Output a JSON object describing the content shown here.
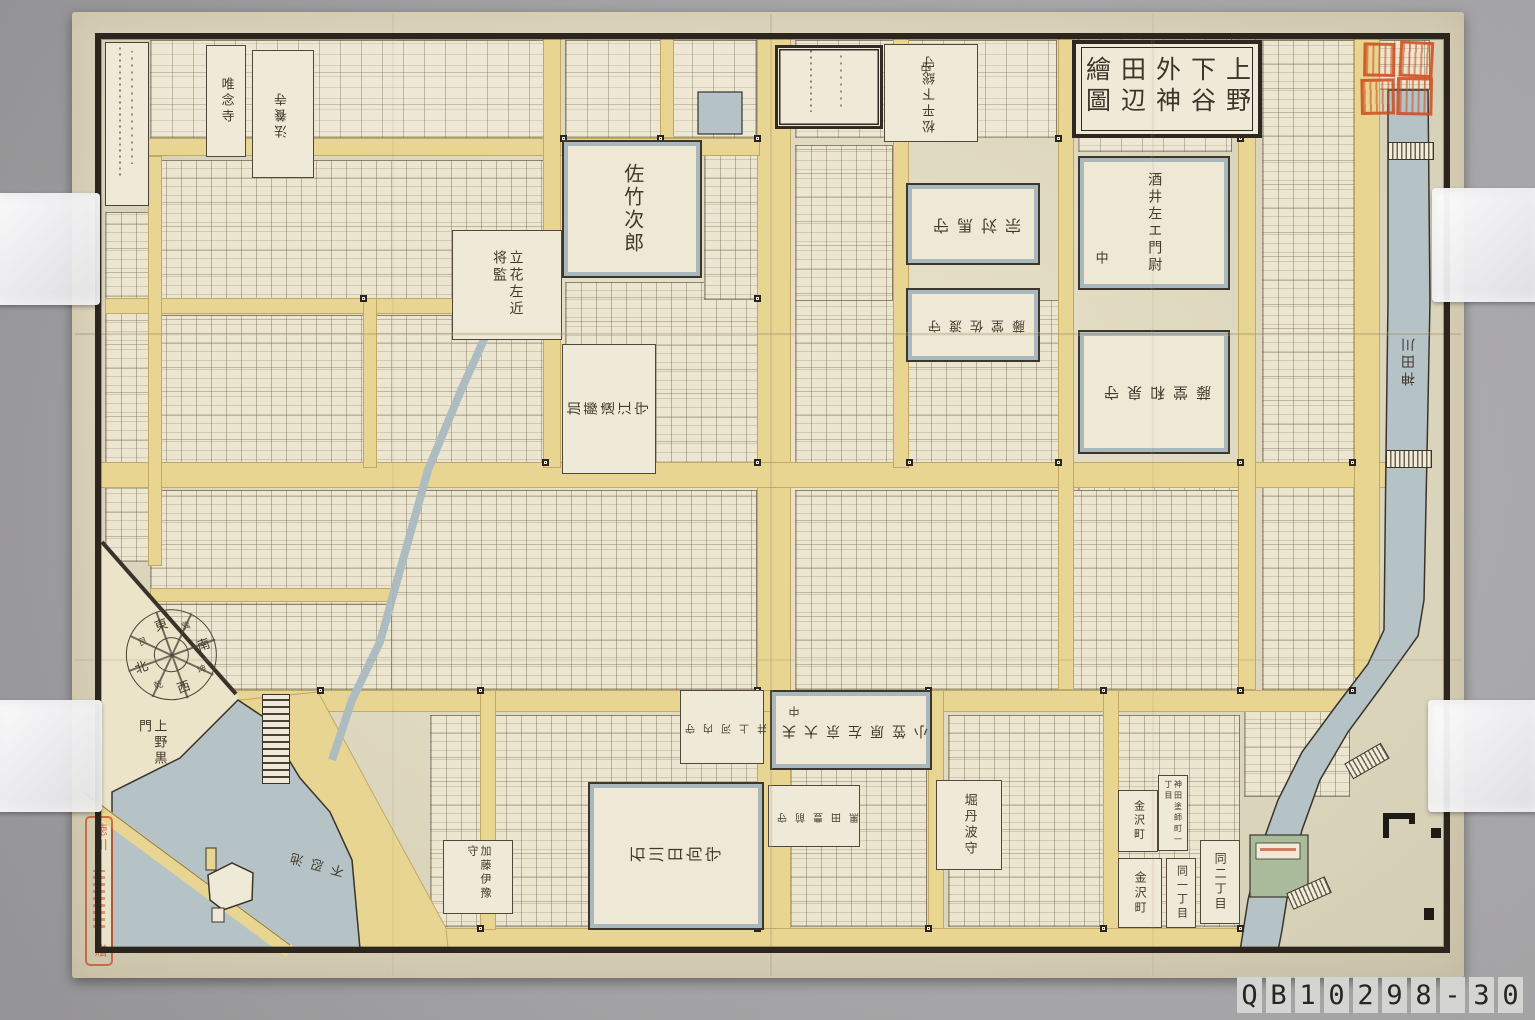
{
  "map": {
    "title": "上野下谷外神田辺繪圖",
    "blocks": [
      {
        "t": "佐竹次郎",
        "x": 562,
        "y": 140,
        "w": 140,
        "h": 138,
        "fs": 20,
        "rot": 0,
        "mode": "v",
        "kind": "big"
      },
      {
        "t": "宗対馬守",
        "x": 906,
        "y": 183,
        "w": 134,
        "h": 82,
        "fs": 16,
        "rot": 180,
        "mode": "h",
        "kind": "big"
      },
      {
        "t": "藤堂佐渡守",
        "x": 906,
        "y": 288,
        "w": 134,
        "h": 74,
        "fs": 13,
        "rot": 180,
        "mode": "h",
        "kind": "big"
      },
      {
        "t": "酒井左エ門尉",
        "x": 1078,
        "y": 156,
        "w": 152,
        "h": 134,
        "fs": 14,
        "rot": 0,
        "mode": "v",
        "kind": "big"
      },
      {
        "t": "中",
        "x": 1090,
        "y": 246,
        "w": 20,
        "h": 26,
        "fs": 13,
        "rot": 0,
        "mode": "v",
        "kind": "bare"
      },
      {
        "t": "藤堂和泉守",
        "x": 1078,
        "y": 330,
        "w": 152,
        "h": 124,
        "fs": 15,
        "rot": 180,
        "mode": "h",
        "kind": "big"
      },
      {
        "t": "立花左近将監",
        "x": 452,
        "y": 230,
        "w": 110,
        "h": 110,
        "fs": 14,
        "rot": 0,
        "mode": "v",
        "kind": "box",
        "mh": 70
      },
      {
        "t": "加藤遠江守",
        "x": 562,
        "y": 344,
        "w": 94,
        "h": 130,
        "fs": 14,
        "rot": -90,
        "mode": "v",
        "kind": "box"
      },
      {
        "t": "松平下総守",
        "x": 884,
        "y": 44,
        "w": 94,
        "h": 98,
        "fs": 13,
        "rot": 180,
        "mode": "v",
        "kind": "box"
      },
      {
        "t": "中",
        "x": 918,
        "y": 56,
        "w": 18,
        "h": 22,
        "fs": 11,
        "rot": 180,
        "mode": "v",
        "kind": "bare"
      },
      {
        "t": "唯念寺",
        "x": 206,
        "y": 45,
        "w": 40,
        "h": 112,
        "fs": 13,
        "rot": 0,
        "mode": "v",
        "kind": "box"
      },
      {
        "t": "法養寺",
        "x": 252,
        "y": 50,
        "w": 62,
        "h": 128,
        "fs": 13,
        "rot": 180,
        "mode": "v",
        "kind": "box"
      },
      {
        "t": "小笠原左京大夫",
        "x": 770,
        "y": 690,
        "w": 162,
        "h": 80,
        "fs": 14,
        "rot": 180,
        "mode": "h",
        "kind": "big"
      },
      {
        "t": "中",
        "x": 786,
        "y": 700,
        "w": 18,
        "h": 22,
        "fs": 11,
        "rot": 180,
        "mode": "v",
        "kind": "bare"
      },
      {
        "t": "井上河内守",
        "x": 680,
        "y": 690,
        "w": 84,
        "h": 74,
        "fs": 10,
        "rot": 180,
        "mode": "h",
        "kind": "box"
      },
      {
        "t": "石川日向守",
        "x": 588,
        "y": 782,
        "w": 176,
        "h": 148,
        "fs": 16,
        "rot": -90,
        "mode": "v",
        "kind": "big"
      },
      {
        "t": "黒田豊前守",
        "x": 768,
        "y": 785,
        "w": 92,
        "h": 62,
        "fs": 10,
        "rot": 180,
        "mode": "h",
        "kind": "box"
      },
      {
        "t": "堀丹波守",
        "x": 936,
        "y": 780,
        "w": 66,
        "h": 90,
        "fs": 13,
        "rot": 0,
        "mode": "v",
        "kind": "box"
      },
      {
        "t": "加藤伊豫守",
        "x": 443,
        "y": 840,
        "w": 70,
        "h": 74,
        "fs": 11,
        "rot": 0,
        "mode": "v",
        "kind": "box"
      },
      {
        "t": "金沢町",
        "x": 1118,
        "y": 790,
        "w": 40,
        "h": 62,
        "fs": 11,
        "rot": 0,
        "mode": "v",
        "kind": "box"
      },
      {
        "t": "金沢町",
        "x": 1118,
        "y": 858,
        "w": 44,
        "h": 70,
        "fs": 12,
        "rot": 0,
        "mode": "v",
        "kind": "box"
      },
      {
        "t": "同一丁目",
        "x": 1166,
        "y": 858,
        "w": 30,
        "h": 70,
        "fs": 11,
        "rot": 0,
        "mode": "v",
        "kind": "box"
      },
      {
        "t": "同二丁目",
        "x": 1200,
        "y": 840,
        "w": 40,
        "h": 84,
        "fs": 12,
        "rot": 0,
        "mode": "v",
        "kind": "box"
      },
      {
        "t": "神田塗師町一丁目",
        "x": 1158,
        "y": 775,
        "w": 30,
        "h": 76,
        "fs": 8,
        "rot": 0,
        "mode": "v",
        "kind": "box"
      },
      {
        "t": "神田川",
        "x": 1396,
        "y": 285,
        "w": 26,
        "h": 150,
        "fs": 14,
        "rot": 180,
        "mode": "v",
        "kind": "bare"
      },
      {
        "t": "上野黒門",
        "x": 128,
        "y": 716,
        "w": 46,
        "h": 66,
        "fs": 13,
        "rot": 0,
        "mode": "v",
        "kind": "bare",
        "mh": 60
      },
      {
        "t": "不忍池",
        "x": 282,
        "y": 850,
        "w": 64,
        "h": 26,
        "fs": 13,
        "rot": 195,
        "mode": "h",
        "kind": "bare"
      }
    ],
    "compass": {
      "cardinals": [
        "東",
        "南",
        "西",
        "北"
      ],
      "ordinals": [
        "巽",
        "坤",
        "乾",
        "艮"
      ]
    },
    "seals": {
      "donor_top": "徳川",
      "donor_bottom": "贈"
    }
  },
  "photo": {
    "catalog_tiles": [
      "Q",
      "B",
      "1",
      "0",
      "2",
      "9",
      "8",
      "-",
      "3",
      "0"
    ]
  },
  "colors": {
    "paper": "#e8e0c5",
    "road_yellow": "#e7d591",
    "water_blue": "#b5c2c6",
    "ink": "#42392d",
    "seal_red": "#cf4a1a",
    "frame": "#2b251e",
    "green_bank": "#a9bb9b",
    "photo_background": "#aaa9ab"
  }
}
